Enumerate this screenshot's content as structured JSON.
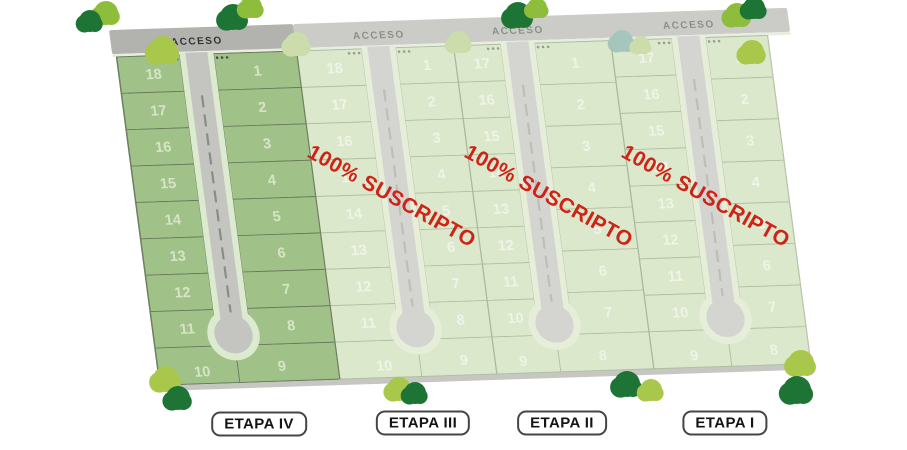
{
  "map": {
    "acceso_label": "ACCESO",
    "suscripto_label": "100% SUSCRIPTO",
    "etapas": [
      {
        "name": "ETAPA IV",
        "sold_out": false,
        "left_lots": [
          "18",
          "17",
          "16",
          "15",
          "14",
          "13",
          "12",
          "11",
          "10"
        ],
        "right_lots": [
          "1",
          "2",
          "3",
          "4",
          "5",
          "6",
          "7",
          "8",
          "9"
        ]
      },
      {
        "name": "ETAPA III",
        "sold_out": true,
        "left_lots": [
          "18",
          "17",
          "16",
          "15",
          "14",
          "13",
          "12",
          "11",
          "10"
        ],
        "right_lots": [
          "1",
          "2",
          "3",
          "4",
          "5",
          "6",
          "7",
          "8",
          "9"
        ]
      },
      {
        "name": "ETAPA II",
        "sold_out": true,
        "left_lots": [
          "17",
          "16",
          "15",
          "14",
          "13",
          "12",
          "11",
          "10",
          "9"
        ],
        "right_lots": [
          "1",
          "2",
          "3",
          "4",
          "5",
          "6",
          "7",
          "8"
        ]
      },
      {
        "name": "ETAPA I",
        "sold_out": true,
        "left_lots": [
          "17",
          "16",
          "15",
          "14",
          "13",
          "12",
          "11",
          "10",
          "9"
        ],
        "right_lots": [
          "1",
          "2",
          "3",
          "4",
          "5",
          "6",
          "7",
          "8"
        ]
      }
    ],
    "colors": {
      "stage_available_fill": "#a0c289",
      "stage_available_stroke": "#66785a",
      "stage_sold_fill": "#dbe8cc",
      "stage_sold_stroke": "#aebfa0",
      "road_available": "#c4c5c1",
      "road_sold": "#d4d5d1",
      "road_ring_available": "#dcead0",
      "road_ring_sold": "#e6edd9",
      "strip_available": "#b2b3af",
      "strip_sold": "#cbccc8",
      "strip_edge_line": "#e9ede0",
      "perimeter_road": "#c6c7c3",
      "dash_available": "#8a8c86",
      "dash_sold": "#bcbfb4",
      "dots_available": "#4a4a4a",
      "dots_sold": "#9a9a96",
      "acceso_text_available": "#333333",
      "acceso_text_sold": "#8c8f87",
      "lot_number_available": "#d7e4c4",
      "lot_number_sold": "#eff4e7",
      "sold_text": "#ce2418",
      "tree_dark": "#1e7434",
      "tree_light": "#8dbd3a",
      "tree_lime": "#a9c74b",
      "tree_washed": "#ccdcab",
      "tree_teal": "#a5c6bd"
    }
  }
}
